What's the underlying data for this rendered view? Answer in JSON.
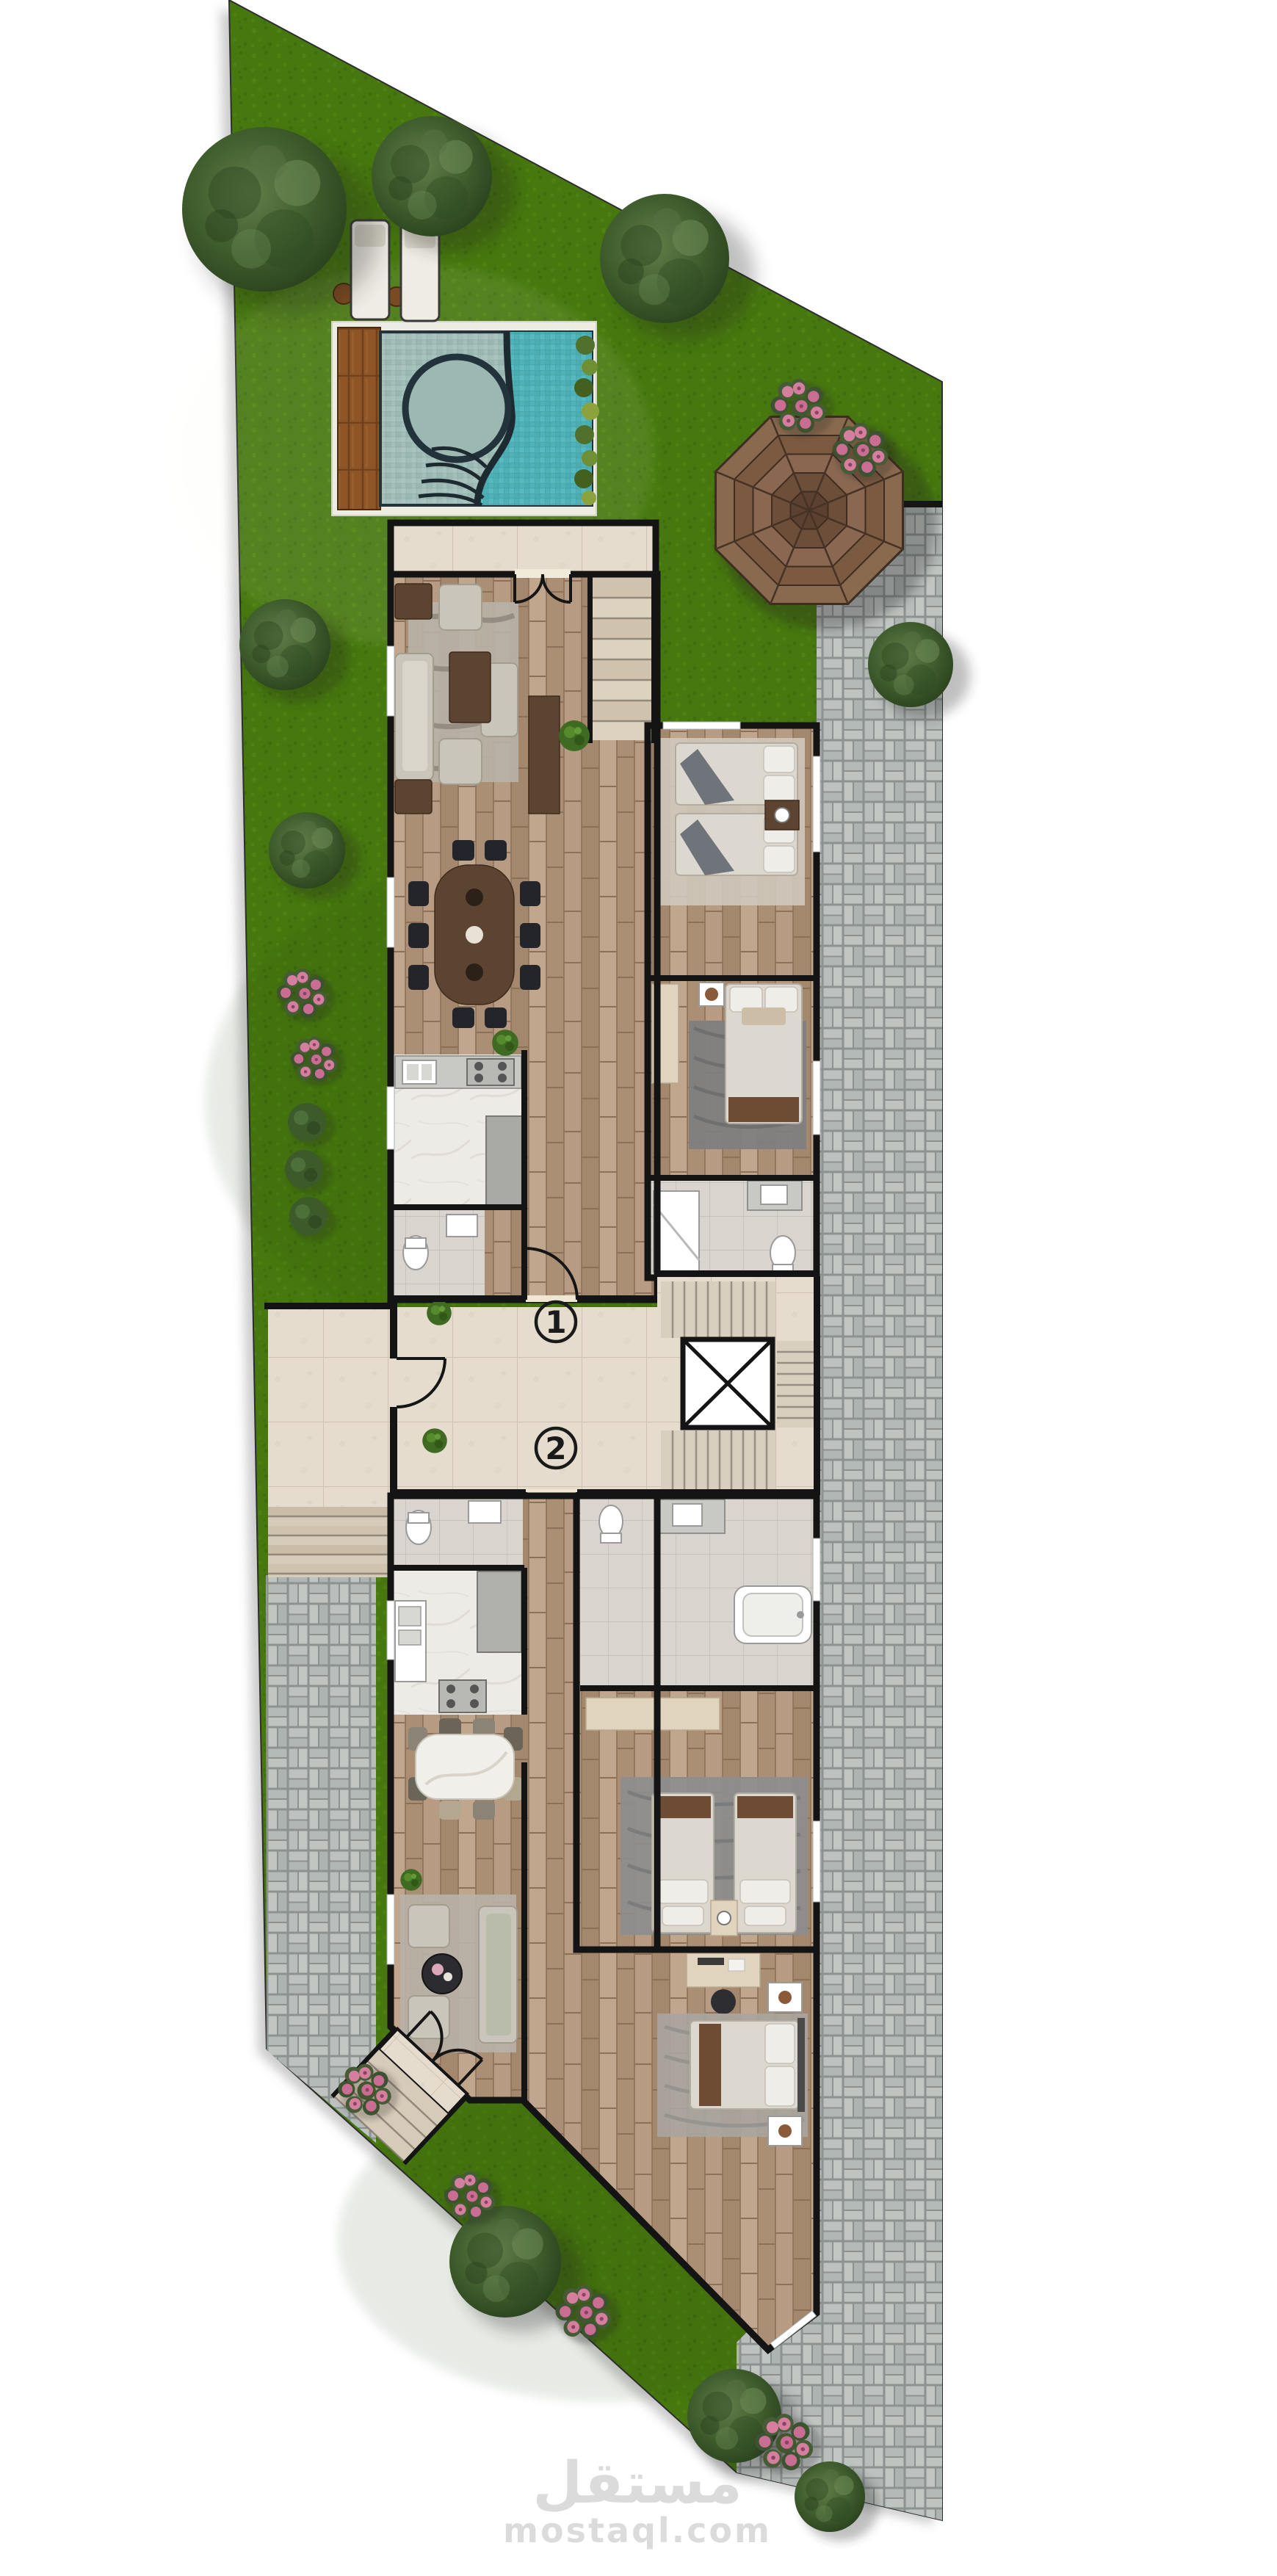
{
  "units": [
    {
      "label": "1"
    },
    {
      "label": "2"
    }
  ],
  "watermark": {
    "brand_arabic": "مستقل",
    "brand_domain": "mostaql.com"
  },
  "colors": {
    "c-bg": "#ffffff",
    "c-grass": "#47780f",
    "c-grass-dark": "#3a660c",
    "c-grass-light": "#568c14",
    "c-paver": "#b6bcba",
    "c-paver-joint": "#8b928f",
    "c-tile": "#e5dccd",
    "c-tile-line": "#cfc3af",
    "c-wood": "#b3977e",
    "c-marble": "#edebe6",
    "c-wall": "#141414",
    "c-pool-shallow": "#a3bfba",
    "c-pool-deep": "#4fb2b8",
    "c-deck": "#8e5526",
    "c-roof": "#826048",
    "c-tree": "#44603a",
    "c-flower": "#d57f9f",
    "c-label": "#1a1a1a",
    "c-watermark": "#dbdbdb"
  }
}
